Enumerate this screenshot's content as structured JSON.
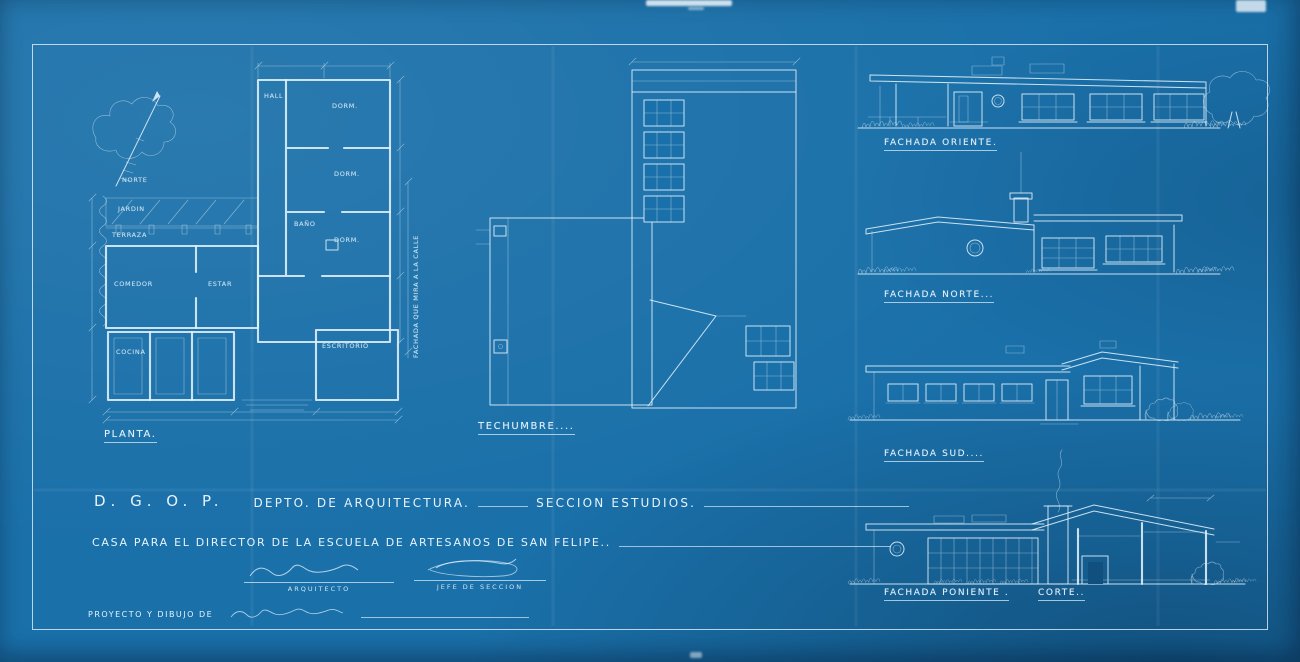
{
  "colors": {
    "paper": "#1a70a9",
    "ink": "#e6f3fd"
  },
  "compass": {
    "label": "NORTE"
  },
  "floor_plan": {
    "title": "PLANTA.",
    "street_note": "FACHADA QUE MIRA A LA CALLE",
    "rooms": [
      "JARDIN",
      "TERRAZA",
      "COMEDOR",
      "ESTAR",
      "HALL",
      "DORM.",
      "DORM.",
      "DORM.",
      "BAÑO",
      "COCINA",
      "ESCRITORIO"
    ]
  },
  "roof_plan": {
    "title": "TECHUMBRE...."
  },
  "elevations": [
    {
      "title": "FACHADA ORIENTE."
    },
    {
      "title": "FACHADA NORTE..."
    },
    {
      "title": "FACHADA SUD...."
    },
    {
      "title": "FACHADA PONIENTE ."
    }
  ],
  "section": {
    "title": "CORTE.."
  },
  "title_block": {
    "agency": "D. G. O. P.",
    "department": "DEPTO. DE ARQUITECTURA.",
    "section_label": "SECCION ESTUDIOS.",
    "project": "CASA PARA EL DIRECTOR DE LA ESCUELA DE ARTESANOS DE SAN FELIPE..",
    "architect_label": "ARQUITECTO",
    "chief_label": "JEFE DE SECCION",
    "credit": "PROYECTO Y DIBUJO DE"
  }
}
